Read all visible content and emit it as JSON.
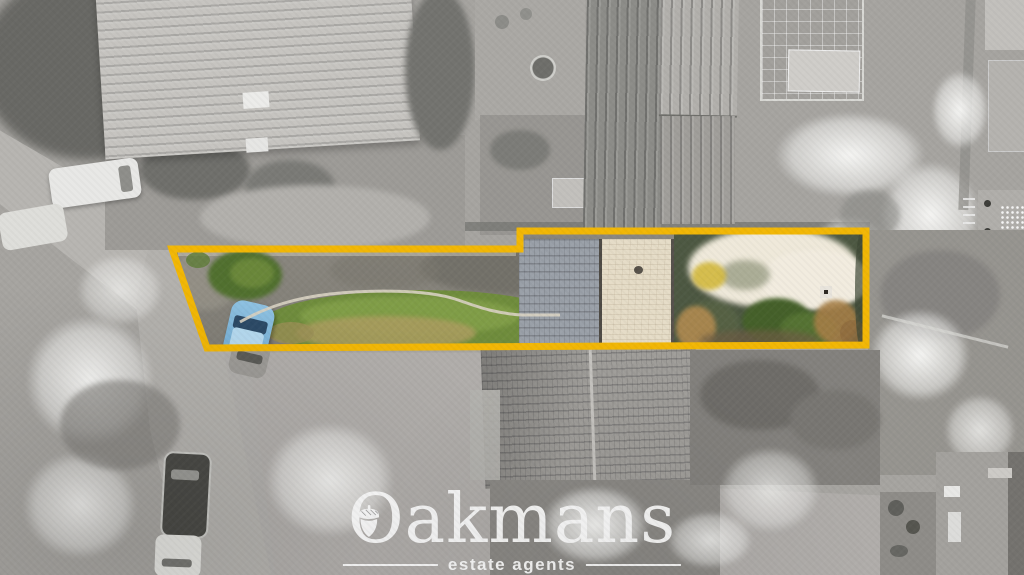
{
  "watermark": {
    "brand": "Oakmans",
    "tagline": "estate agents",
    "icon": "acorn"
  },
  "boundary": {
    "points": "172,249 520,249 520,231 866,231 866,345 207,348",
    "color": "#F2B705",
    "stroke_width": "7"
  },
  "palette": {
    "logo_white": "#FFFFFF",
    "lawn_green": "#6F8C3C",
    "car_blue": "#7FB9DE",
    "roof_slate": "#9AA0A8",
    "roof_cream": "#E5DCC7",
    "blossom_white": "#EFE9DA",
    "curb_stone": "#D8D2C2"
  }
}
